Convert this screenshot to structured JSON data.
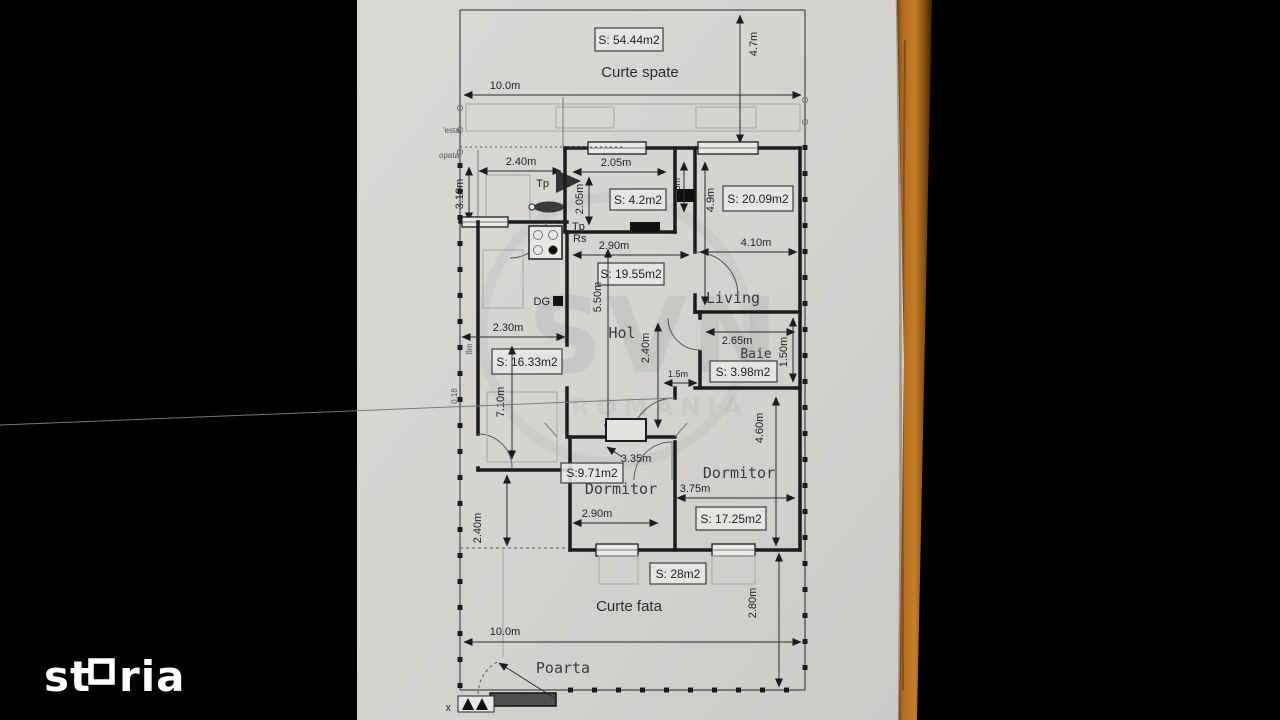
{
  "branding": {
    "logo_text": "storia",
    "logo_prefix": "st",
    "logo_suffix": "ria",
    "watermark_line1": "SVN",
    "watermark_line2": "ROMANIA"
  },
  "colors": {
    "background": "#000000",
    "paper": "#d6d5d2",
    "ink": "#222222",
    "wood": "#b06a1e",
    "logo": "#ffffff"
  },
  "plan": {
    "back_yard": {
      "name": "Curte spate",
      "area_label": "S: 54.44m2",
      "dim_width": "10.0m",
      "dim_depth": "4.7m"
    },
    "porch": {
      "dim_width": "2.40m",
      "dim_depth": "3.10m",
      "note_left_1": "'esta,",
      "note_left_2": "opata,"
    },
    "pantry": {
      "area_label": "S: 4.2m2",
      "dim_width": "2.05m",
      "dim_depth": "2.05m",
      "dim_niche": "2.5m"
    },
    "living": {
      "name": "Living",
      "area_label": "S: 20.09m2",
      "dim_width": "4.10m",
      "dim_depth": "4.9m"
    },
    "hall": {
      "name": "Hol",
      "area_label": "S: 19.55m2",
      "dim_width_top": "2.90m",
      "dim_length": "5.50m",
      "dim_width_mid": "2.40m",
      "dim_pass": "1.5m"
    },
    "kitchen": {
      "area_label": "S: 16.33m2",
      "dim_width": "2.30m",
      "dim_depth": "7.10m",
      "dim_side": "8m",
      "dim_wall": "0.18"
    },
    "bathroom": {
      "name": "Baie",
      "area_label": "S: 3.98m2",
      "dim_width": "2.65m",
      "dim_depth": "1.50m"
    },
    "bedroom_left": {
      "name": "Dormitor",
      "area_label": "S:9.71m2",
      "dim_width": "2.90m",
      "dim_diag": "3.35m"
    },
    "bedroom_right": {
      "name": "Dormitor",
      "area_label": "S: 17.25m2",
      "dim_width": "3.75m",
      "dim_depth": "4.60m"
    },
    "front_yard": {
      "name": "Curte fata",
      "area_label": "S: 28m2",
      "dim_width": "10.0m",
      "dim_depth": "2.80m",
      "dim_porch": "2.40m"
    },
    "gate": {
      "name": "Poarta",
      "corner_mark": "x"
    },
    "symbols": {
      "tp_upper": "Tp",
      "tp_lower": "Tp",
      "rs": "Rs",
      "dg": "DG"
    }
  }
}
